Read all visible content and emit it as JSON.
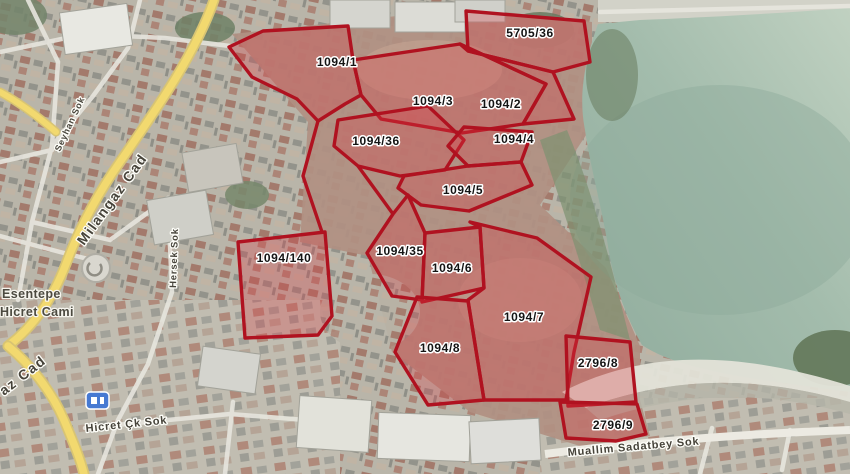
{
  "map": {
    "parcels": [
      {
        "id": "5705/36"
      },
      {
        "id": "1094/1"
      },
      {
        "id": "1094/3"
      },
      {
        "id": "1094/2"
      },
      {
        "id": "1094/36"
      },
      {
        "id": "1094/4"
      },
      {
        "id": "1094/5"
      },
      {
        "id": "1094/140"
      },
      {
        "id": "1094/35"
      },
      {
        "id": "1094/6"
      },
      {
        "id": "1094/7"
      },
      {
        "id": "1094/8"
      },
      {
        "id": "2796/8"
      },
      {
        "id": "2796/9"
      }
    ],
    "streets": [
      {
        "name": "Milangaz Cad"
      },
      {
        "name": "Seyhan Sok"
      },
      {
        "name": "Hersek Sok"
      },
      {
        "name": "az Cad"
      },
      {
        "name": "Hicret Çk Sok"
      },
      {
        "name": "Muallim Sadatbey Sok"
      }
    ],
    "poi": {
      "line1": "Esentepe",
      "line2": "Hicret Cami"
    },
    "colors": {
      "parcel_stroke": "#b01220",
      "parcel_fill": "rgba(220,60,70,0.30)",
      "water": "#a3bcac",
      "road_yellow": "#f2d96f",
      "label_text": "#141414",
      "label_halo": "#ffffff"
    }
  }
}
